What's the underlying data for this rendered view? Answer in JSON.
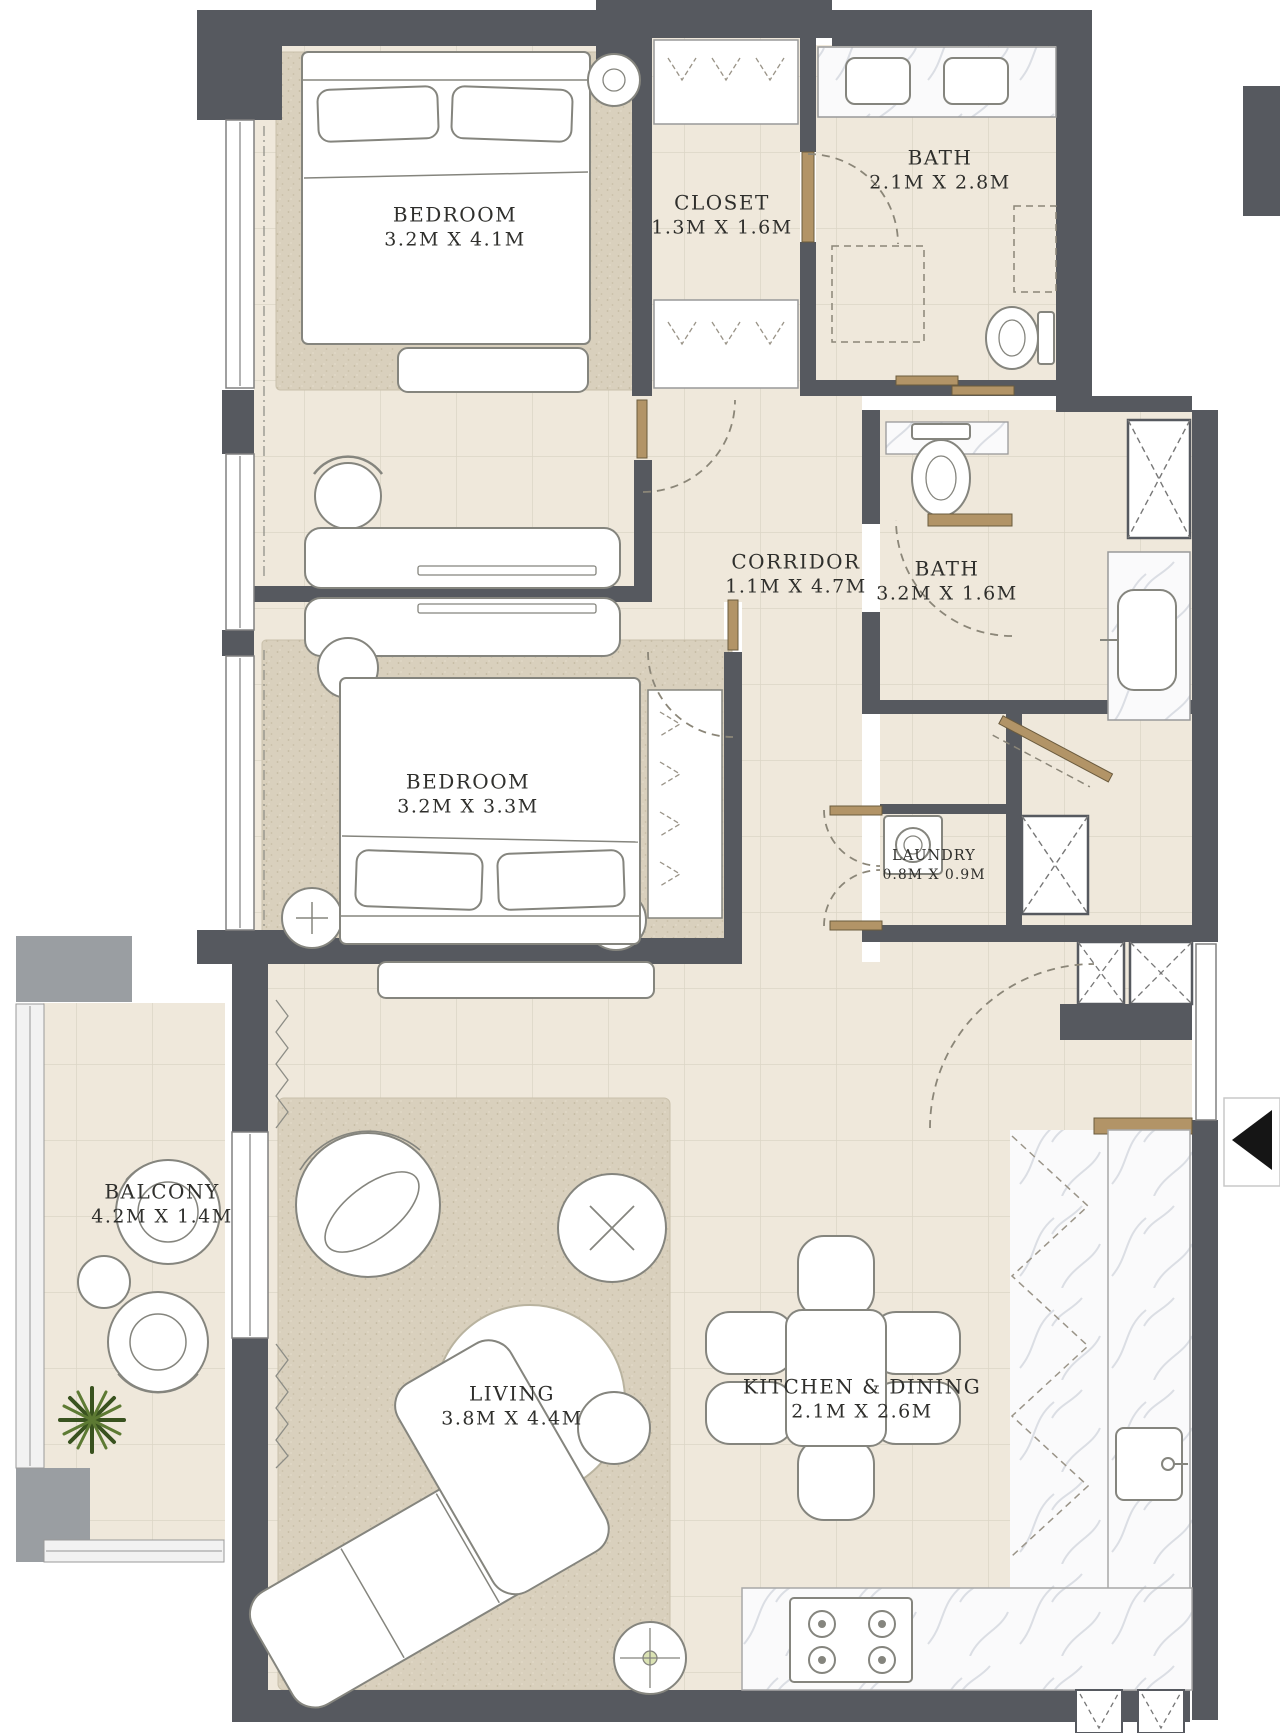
{
  "plan": {
    "type": "apartment-floor-plan",
    "rooms": [
      {
        "id": "bedroom-1",
        "name": "BEDROOM",
        "dims": "3.2M X 4.1M"
      },
      {
        "id": "closet",
        "name": "CLOSET",
        "dims": "1.3M X 1.6M"
      },
      {
        "id": "bath-1",
        "name": "BATH",
        "dims": "2.1M X 2.8M"
      },
      {
        "id": "corridor",
        "name": "CORRIDOR",
        "dims": "1.1M X 4.7M"
      },
      {
        "id": "bath-2",
        "name": "BATH",
        "dims": "3.2M X 1.6M"
      },
      {
        "id": "bedroom-2",
        "name": "BEDROOM",
        "dims": "3.2M X 3.3M"
      },
      {
        "id": "laundry",
        "name": "LAUNDRY",
        "dims": "0.8M X 0.9M"
      },
      {
        "id": "balcony",
        "name": "BALCONY",
        "dims": "4.2M X 1.4M"
      },
      {
        "id": "living",
        "name": "LIVING",
        "dims": "3.8M X 4.4M"
      },
      {
        "id": "kitchen-dining",
        "name": "KITCHEN & DINING",
        "dims": "2.1M X 2.6M"
      }
    ],
    "icons": {
      "entry_arrow": "◀"
    },
    "colors": {
      "wall": "#56595F",
      "floor": "#EFE8DB",
      "rug": "#D9D0BD",
      "door": "#B29467",
      "marble": "#FBFBFC",
      "label": "#2F2F2C",
      "balcony_structure": "#9A9EA2"
    }
  }
}
